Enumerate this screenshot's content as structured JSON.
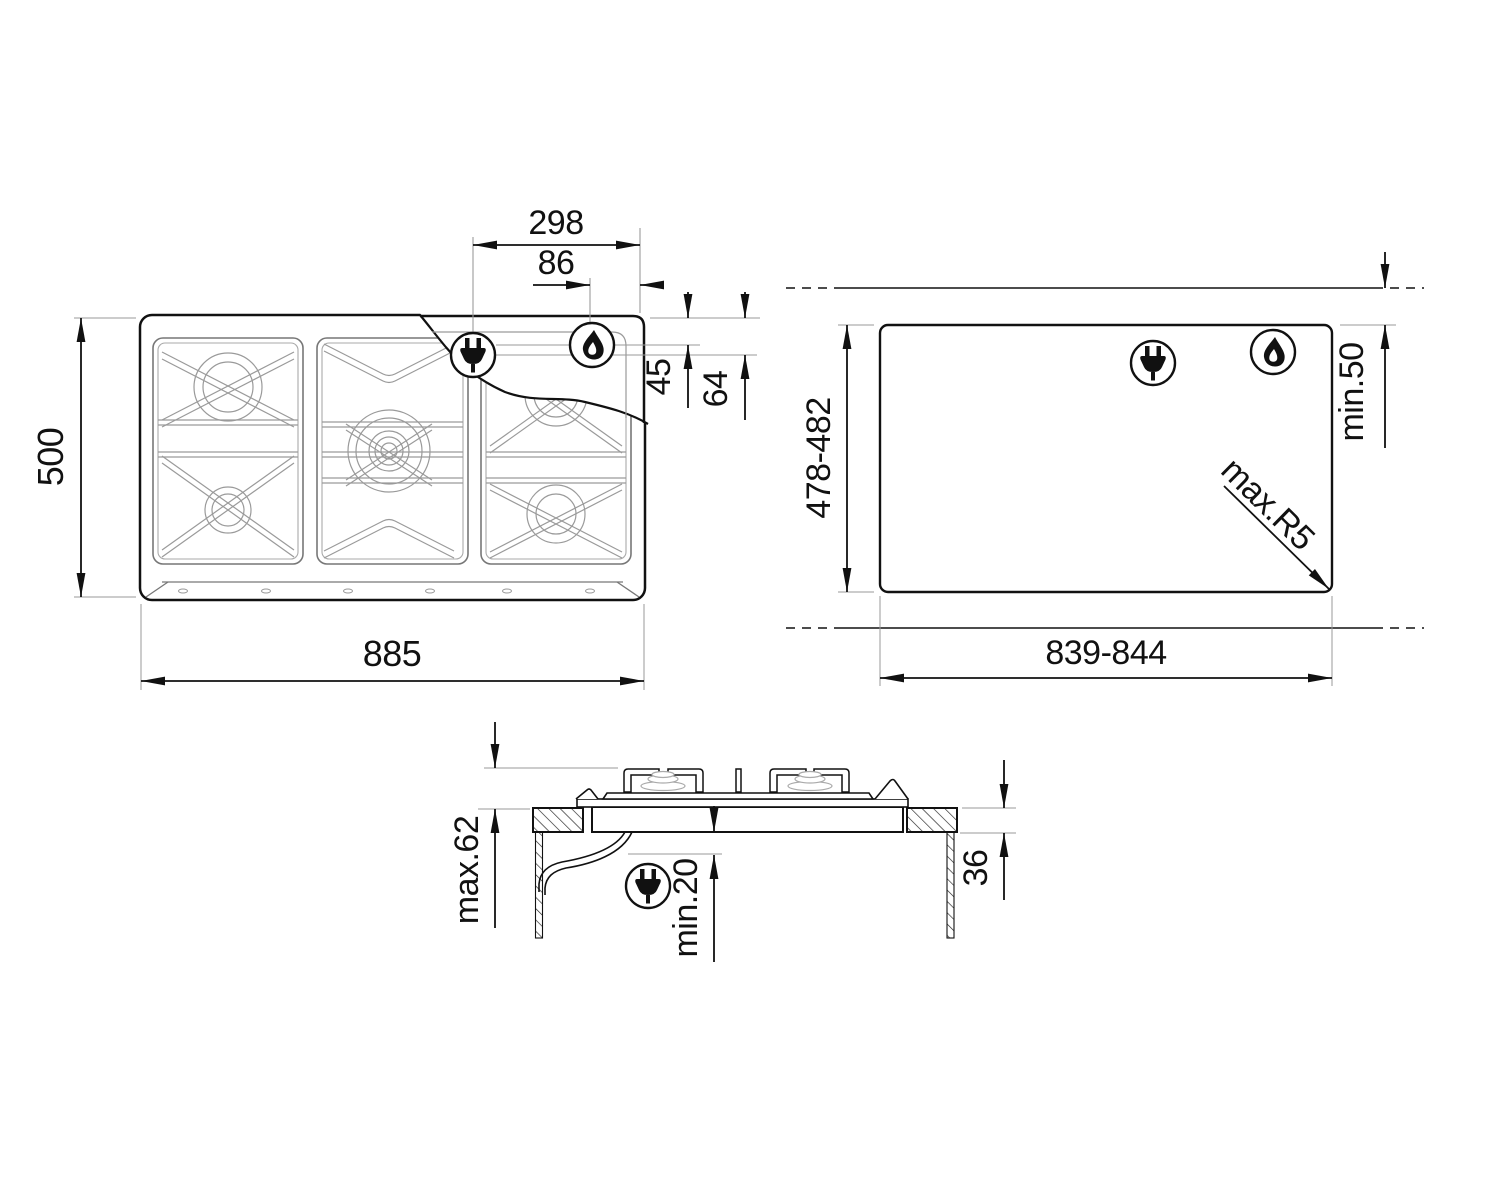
{
  "diagram": {
    "product": "gas-hob-installation-drawing",
    "views": {
      "plan": "hob-top-view",
      "cutout": "worktop-cutout-view",
      "section": "side-section-view"
    },
    "dims": {
      "plan_width": "885",
      "plan_depth": "500",
      "plug_offset_x": "298",
      "flame_offset_x": "86",
      "flame_offset_y": "45",
      "plug_offset_y": "64",
      "cutout_depth": "478-482",
      "cutout_width": "839-844",
      "rear_clearance": "min.50",
      "corner_radius": "max.R5",
      "section_height": "max.62",
      "clearance_below": "min.20",
      "worktop_thickness": "36"
    },
    "icons": {
      "plug": "power-plug",
      "flame": "gas-flame"
    },
    "colors": {
      "line": "#1a1a1a",
      "detail": "#9a9a9a",
      "background": "#ffffff"
    }
  }
}
